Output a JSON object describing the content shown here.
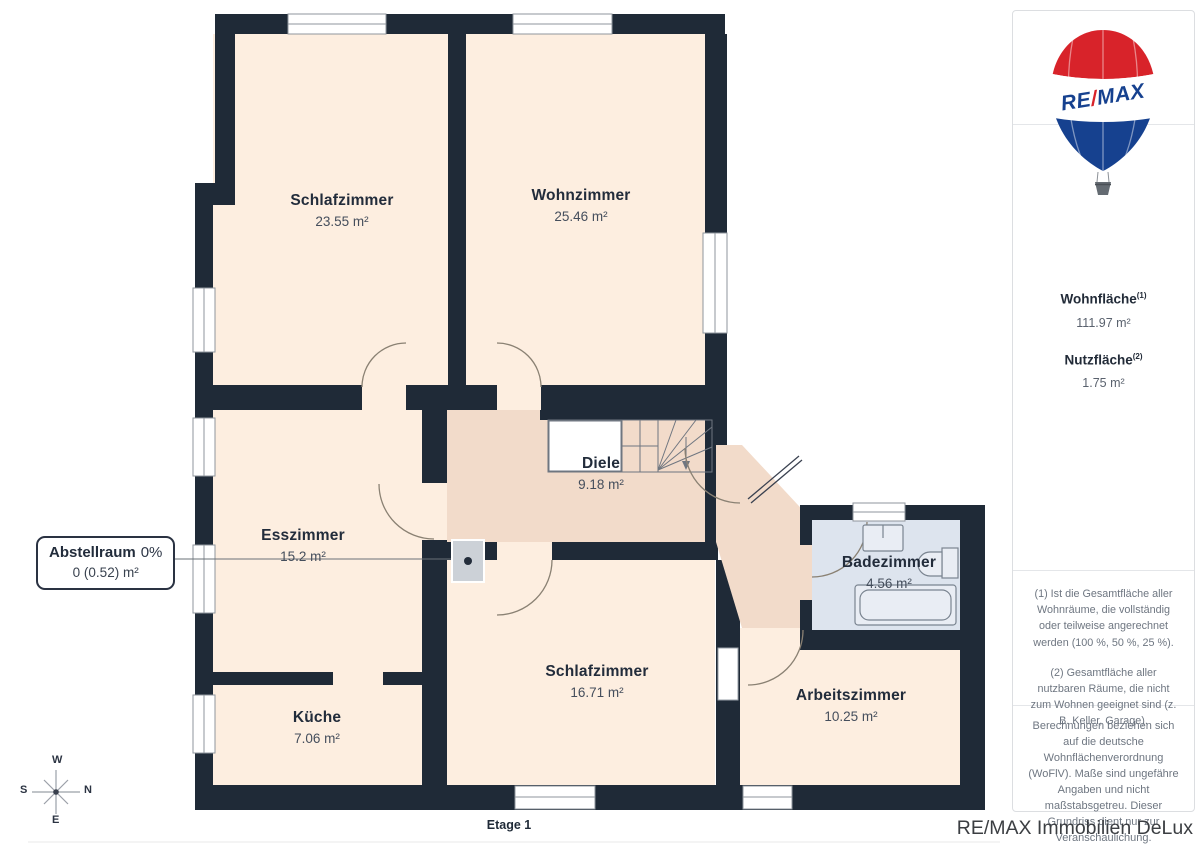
{
  "page": {
    "floor_label": "Etage 1"
  },
  "floorplan": {
    "rooms": [
      {
        "name": "Schlafzimmer",
        "area": "23.55 m²"
      },
      {
        "name": "Wohnzimmer",
        "area": "25.46 m²"
      },
      {
        "name": "Esszimmer",
        "area": "15.2 m²"
      },
      {
        "name": "Diele",
        "area": "9.18 m²"
      },
      {
        "name": "Küche",
        "area": "7.06 m²"
      },
      {
        "name": "Schlafzimmer",
        "area": "16.71 m²"
      },
      {
        "name": "Badezimmer",
        "area": "4.56 m²"
      },
      {
        "name": "Arbeitszimmer",
        "area": "10.25 m²"
      }
    ],
    "callout": {
      "label": "Abstellraum",
      "percent": "0%",
      "area": "0 (0.52) m²"
    },
    "compass": {
      "top": "W",
      "left": "S",
      "right": "N",
      "bottom": "E"
    }
  },
  "sidebar": {
    "logo": {
      "left": "RE",
      "slash": "/",
      "right": "MAX"
    },
    "metrics": [
      {
        "label": "Wohnfläche",
        "superscript": "(1)",
        "value": "111.97 m²"
      },
      {
        "label": "Nutzfläche",
        "superscript": "(2)",
        "value": "1.75 m²"
      }
    ],
    "footnotes": [
      "(1) Ist die Gesamtfläche aller Wohnräume, die vollständig oder teilweise angerechnet werden (100 %, 50 %, 25 %).",
      "(2) Gesamtfläche aller nutzbaren Räume, die nicht zum Wohnen geeignet sind (z. B. Keller, Garage)."
    ],
    "disclaimer": "Berechnungen beziehen sich auf die deutsche Wohnflächenverordnung (WoFlV). Maße sind ungefähre Angaben und nicht maßstabsgetreu. Dieser Grundriss dient nur zur Veranschaulichung.",
    "brand": {
      "giraffe": "GIRAFFE",
      "suffix": "360"
    },
    "agency": "RE/MAX Immobilien DeLux"
  },
  "colors": {
    "wall": "#1f2a37",
    "room": "#fdeee0",
    "hallway": "#f2dbca",
    "bathroom": "#dde4ee",
    "storage": "#ccd1d7",
    "remax_red": "#d8232a",
    "remax_blue": "#16418f"
  }
}
